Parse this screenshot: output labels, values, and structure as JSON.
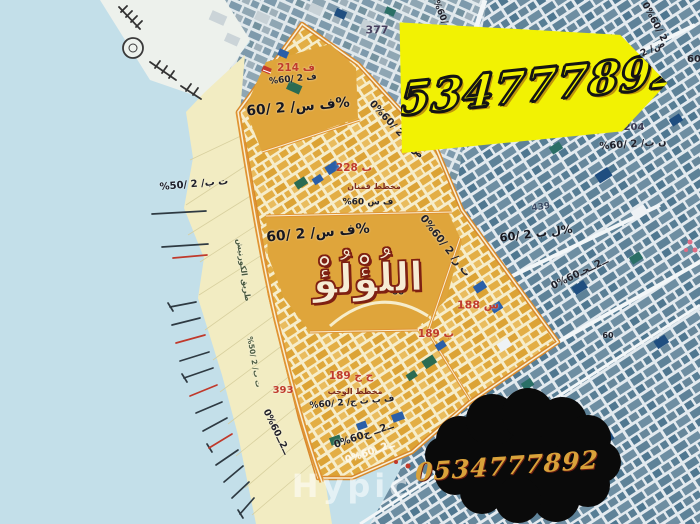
{
  "banner": {
    "phone": "0534777892"
  },
  "cloud": {
    "phone": "0534777892"
  },
  "watermark": {
    "text": "Hypic"
  },
  "title": {
    "text": "اللُؤْلُؤْ"
  },
  "colors": {
    "sea": "#C3DFE9",
    "coast": "#F2ECC2",
    "marina": "#EDF1EC",
    "district_orange": "#DFA53B",
    "district_border": "#D8892D",
    "banner_bg": "#F2F203",
    "banner_outline": "#141414",
    "cloud_bg": "#0A0A0A",
    "cloud_text": "#D9A23A",
    "title_fill": "#F6ECD4",
    "title_stroke": "#7E2012",
    "watermark": "rgba(255,255,255,0.55)"
  },
  "labels": [
    {
      "n": "num-377",
      "t": "377",
      "x": 377,
      "y": 30,
      "s": 11,
      "c": "#463F5E",
      "r": 0
    },
    {
      "n": "num-214",
      "t": "214 ف",
      "x": 296,
      "y": 68,
      "s": 10.5,
      "c": "#C03B2C",
      "r": 0
    },
    {
      "n": "lbl-pct-a",
      "t": "%60/ 2 ف",
      "x": 293,
      "y": 80,
      "s": 9,
      "c": "#20202A",
      "r": -6
    },
    {
      "n": "lbl-main-a",
      "t": "60/ 2 /ف س%",
      "x": 298,
      "y": 107,
      "s": 14,
      "c": "#17171F",
      "r": -5,
      "b": 1
    },
    {
      "n": "diag-road-ab",
      "t": "0%60/ 2 /ض ر",
      "x": 396,
      "y": 130,
      "s": 10,
      "c": "#20202A",
      "r": 47
    },
    {
      "n": "num-228",
      "t": "228 ب",
      "x": 354,
      "y": 168,
      "s": 10.5,
      "c": "#C03B2C",
      "r": 0
    },
    {
      "n": "lbl-plan-b",
      "t": "مخطط قمنان",
      "x": 374,
      "y": 187,
      "s": 8,
      "c": "#7D2B1C",
      "r": 0
    },
    {
      "n": "lbl-pct-b",
      "t": "%60 ف س",
      "x": 368,
      "y": 203,
      "s": 9,
      "c": "#20202A",
      "r": 0
    },
    {
      "n": "lbl-main-b",
      "t": "60/ 2 /ف س%",
      "x": 318,
      "y": 233,
      "s": 14,
      "c": "#17171F",
      "r": -5,
      "b": 1
    },
    {
      "n": "diag-road-bc",
      "t": "0%60/ 2 /ت ر",
      "x": 445,
      "y": 246,
      "s": 10.5,
      "c": "#20202A",
      "r": 52
    },
    {
      "n": "num-204",
      "t": "204",
      "x": 634,
      "y": 128,
      "s": 10,
      "c": "#3C3C54",
      "r": 0
    },
    {
      "n": "lbl-pct-204",
      "t": "%ن ب/ 2 /60",
      "x": 633,
      "y": 145,
      "s": 10,
      "c": "#20202A",
      "r": -4
    },
    {
      "n": "num-439",
      "t": "439",
      "x": 541,
      "y": 208,
      "s": 9,
      "c": "#3C4C66",
      "r": -8
    },
    {
      "n": "lbl-60-right",
      "t": "60/ 2 ل ب%",
      "x": 536,
      "y": 234,
      "s": 11.5,
      "c": "#17171F",
      "r": -7,
      "b": 1
    },
    {
      "n": "diag-road-right",
      "t": "0%60ــ2ــجـ",
      "x": 580,
      "y": 274,
      "s": 10,
      "c": "#20202A",
      "r": -26
    },
    {
      "n": "num-188",
      "t": "188 س",
      "x": 478,
      "y": 305,
      "s": 11,
      "c": "#C03B2C",
      "r": 0
    },
    {
      "n": "num-189-b",
      "t": "189 ب",
      "x": 436,
      "y": 334,
      "s": 10.5,
      "c": "#C03B2C",
      "r": 0
    },
    {
      "n": "num-189-hj",
      "t": "189 ح ج",
      "x": 351,
      "y": 376,
      "s": 10.5,
      "c": "#C03B2C",
      "r": 0
    },
    {
      "n": "lbl-plan-e",
      "t": "مخطط الوجب",
      "x": 355,
      "y": 392,
      "s": 8,
      "c": "#7D2B1C",
      "r": 0
    },
    {
      "n": "lbl-pct-e",
      "t": "%60/ 2 /ف ب ث ج",
      "x": 352,
      "y": 403,
      "s": 9,
      "c": "#20202A",
      "r": -5
    },
    {
      "n": "num-393",
      "t": "393",
      "x": 283,
      "y": 391,
      "s": 10,
      "c": "#C03B2C",
      "r": 0
    },
    {
      "n": "lbl-coast-50",
      "t": "%ت ب/ 2 /50",
      "x": 194,
      "y": 185,
      "s": 10,
      "c": "#20202A",
      "r": -5
    },
    {
      "n": "corniche-label",
      "t": "طريق الكورنيش",
      "x": 243,
      "y": 270,
      "s": 8,
      "c": "#4A5A40",
      "r": 82
    },
    {
      "n": "corniche-label-2",
      "t": "%ت ب/ 2 /50",
      "x": 254,
      "y": 362,
      "s": 7.5,
      "c": "#4A5A40",
      "r": 80
    },
    {
      "n": "diag-road-tr",
      "t": "0%60/ 2",
      "x": 654,
      "y": 22,
      "s": 9.5,
      "c": "#20202A",
      "r": 62
    },
    {
      "n": "lbl-dhad-2",
      "t": "ض/ 2",
      "x": 653,
      "y": 49,
      "s": 9.5,
      "c": "#20202A",
      "r": -25
    },
    {
      "n": "num-60-edge",
      "t": "60",
      "x": 694,
      "y": 60,
      "s": 10,
      "c": "#20202A",
      "r": 0
    },
    {
      "n": "num-60-small",
      "t": "60",
      "x": 608,
      "y": 336,
      "s": 8,
      "c": "#20202A",
      "r": 0
    },
    {
      "n": "num-60-c",
      "t": "60",
      "x": 398,
      "y": 293,
      "s": 9,
      "c": "#20202A",
      "r": 0
    },
    {
      "n": "diag-road-coast",
      "t": "0%60ــ2ــ",
      "x": 276,
      "y": 432,
      "s": 9.5,
      "c": "#20202A",
      "r": 64
    },
    {
      "n": "diag-road-e",
      "t": "0%60ــ2ــ ج",
      "x": 364,
      "y": 436,
      "s": 10,
      "c": "#20202A",
      "r": -19
    },
    {
      "n": "road-label-white",
      "t": "0%60ــ2ــ",
      "x": 370,
      "y": 453,
      "s": 10,
      "c": "#FDF8EA",
      "r": -19
    },
    {
      "n": "diag-road-tl",
      "t": "0%60/ 2",
      "x": 440,
      "y": 14,
      "s": 9,
      "c": "#20202A",
      "r": 68
    }
  ]
}
